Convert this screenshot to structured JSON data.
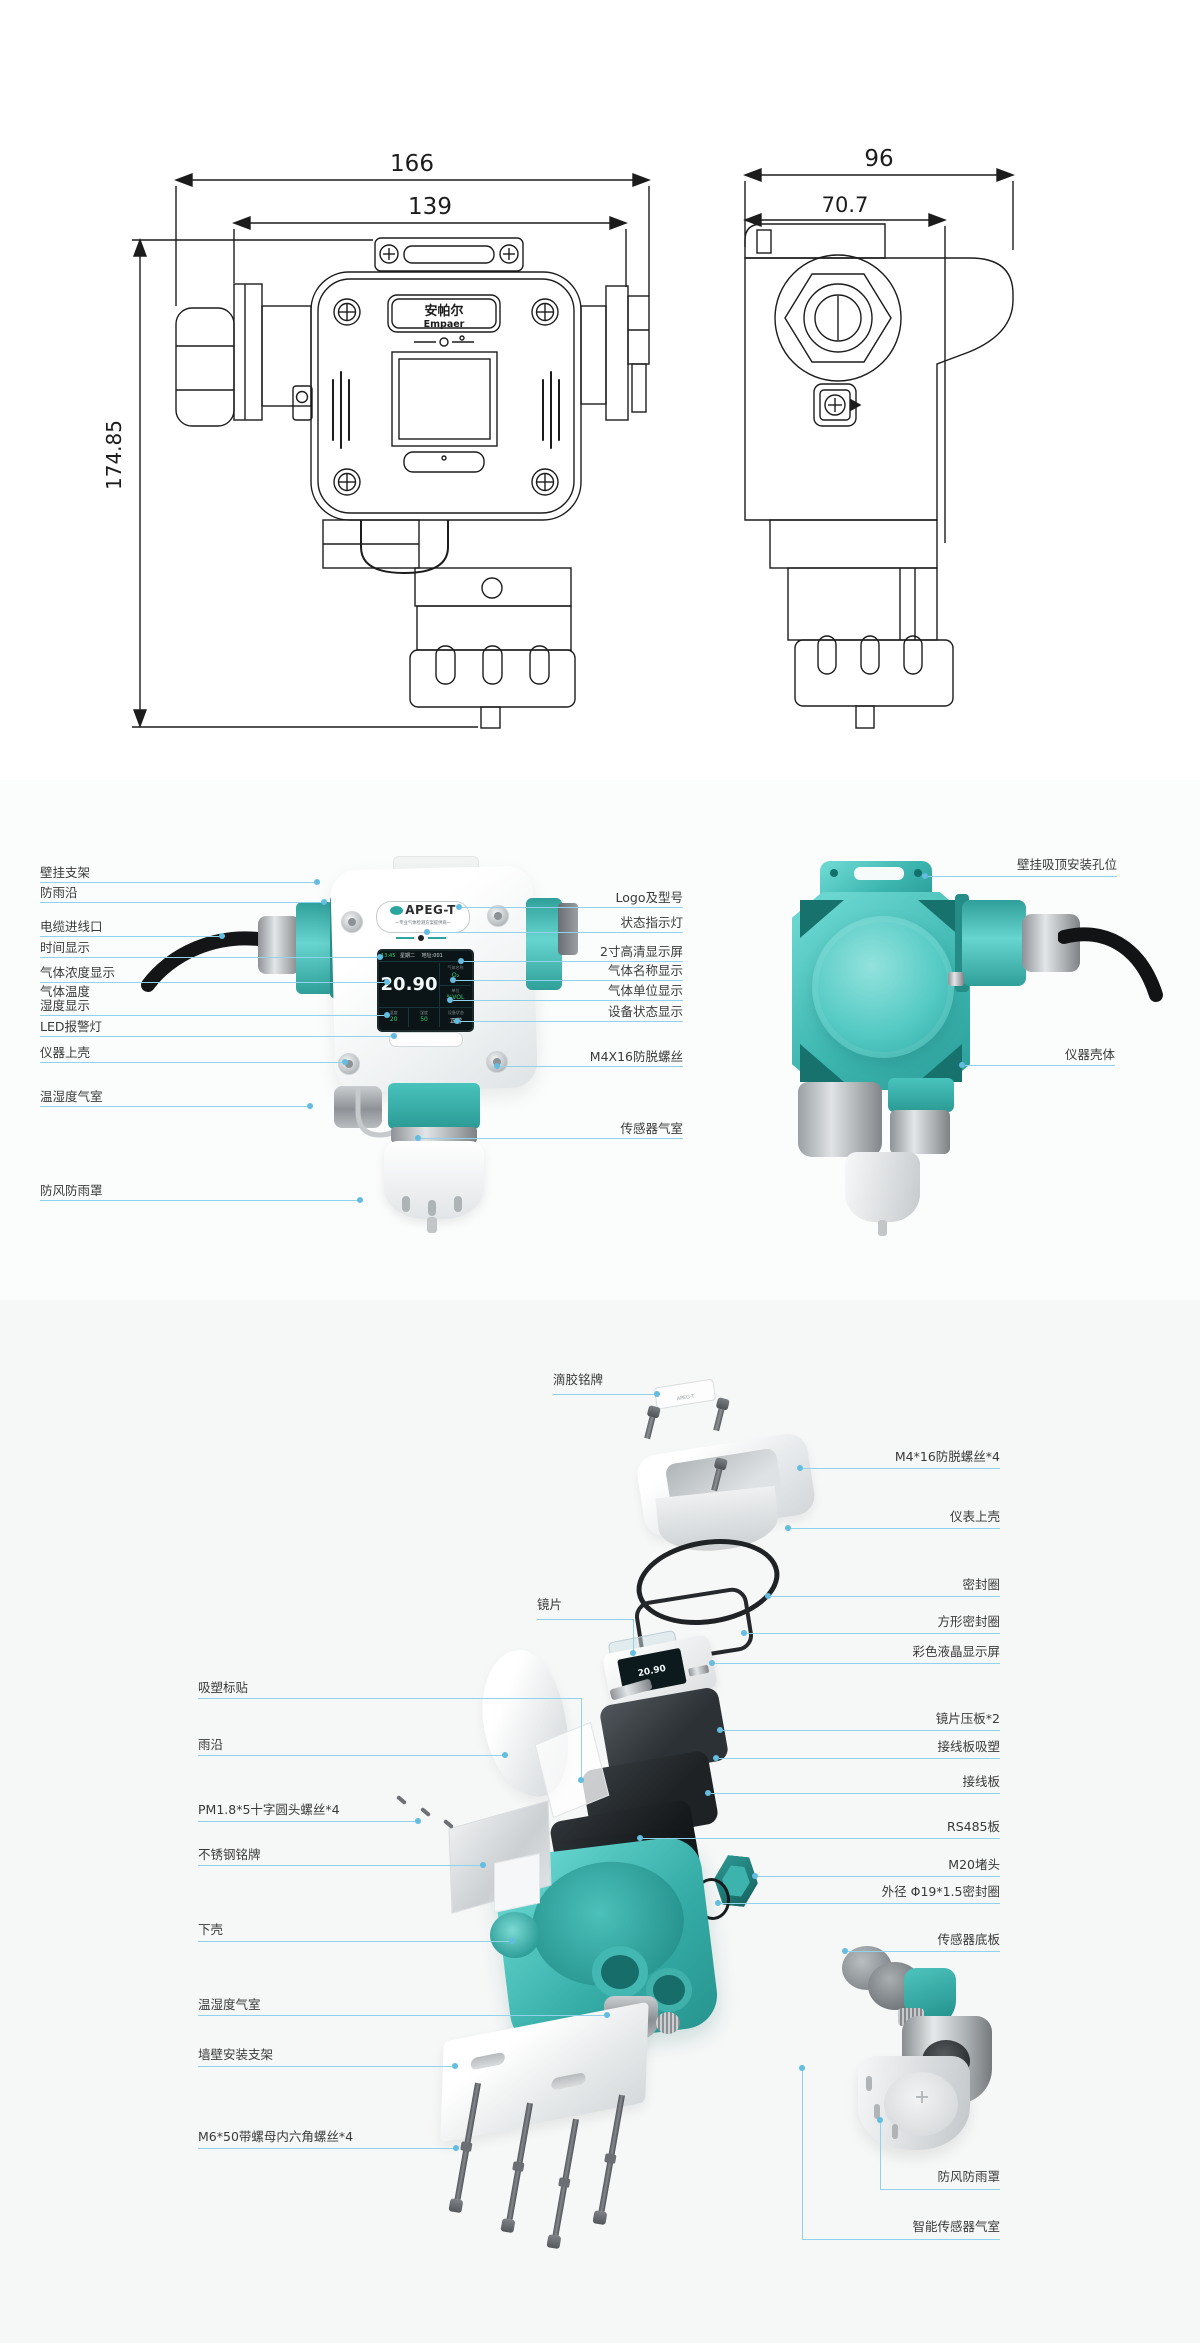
{
  "colors": {
    "teal": "#3CB5AF",
    "callout_line": "#8FD2EA",
    "callout_dot": "#63BDE0",
    "drawing_line": "#1C1C1C",
    "label_text": "#3A3A3A",
    "screen_green": "#35D073"
  },
  "drawings": {
    "front_view": {
      "dim_outer": "166",
      "dim_inner": "139",
      "dim_height": "174.85",
      "brand_cn": "安帕尔",
      "brand_en": "Empaer"
    },
    "side_view": {
      "dim_outer": "96",
      "dim_inner": "70.7"
    }
  },
  "product": {
    "model": "APEG-T",
    "tagline": "—专业气体检测方案提供商—",
    "screen": {
      "time": "13:45",
      "week": "星期二",
      "addr": "地址:001",
      "value": "20.90",
      "gas_label": "气体名称",
      "gas": "O₂",
      "unit_label": "单位",
      "unit": "%VOL",
      "temp_label": "温度",
      "temp": "20",
      "hum_label": "湿度",
      "hum": "50",
      "status_label": "设备状态",
      "status": "正常"
    }
  },
  "middle_callouts": {
    "left": [
      "壁挂支架",
      "防雨沿",
      "电缆进线口",
      "时间显示",
      "气体浓度显示",
      "气体温度",
      "湿度显示",
      "LED报警灯",
      "仪器上壳",
      "温湿度气室",
      "防风防雨罩"
    ],
    "center": [
      "Logo及型号",
      "状态指示灯",
      "2寸高清显示屏",
      "气体名称显示",
      "气体单位显示",
      "设备状态显示",
      "M4X16防脱螺丝",
      "传感器气室"
    ],
    "right": [
      "壁挂吸顶安装孔位",
      "仪器壳体"
    ]
  },
  "exploded_callouts": {
    "left": [
      "滴胶铭牌",
      "镜片",
      "吸塑标贴",
      "雨沿",
      "PM1.8*5十字圆头螺丝*4",
      "不锈钢铭牌",
      "下壳",
      "温湿度气室",
      "墙壁安装支架",
      "M6*50带螺母内六角螺丝*4"
    ],
    "right": [
      "M4*16防脱螺丝*4",
      "仪表上壳",
      "密封圈",
      "方形密封圈",
      "彩色液晶显示屏",
      "镜片压板*2",
      "接线板吸塑",
      "接线板",
      "RS485板",
      "M20堵头",
      "外径 Φ19*1.5密封圈",
      "传感器底板",
      "防风防雨罩",
      "智能传感器气室"
    ]
  }
}
